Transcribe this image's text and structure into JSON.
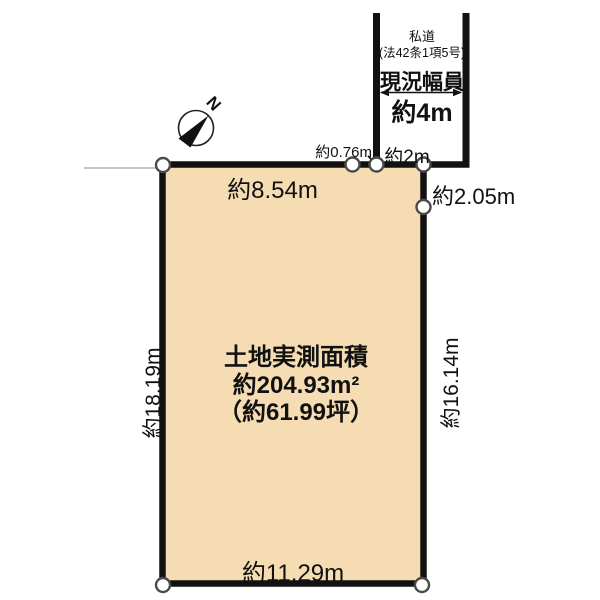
{
  "colors": {
    "background": "#ffffff",
    "parcel_fill": "#f6dcb3",
    "boundary_line": "#111111",
    "marker_stroke": "#4a4a4a",
    "faint_line": "#b3b3b3"
  },
  "compass": {
    "north_label": "N"
  },
  "road": {
    "name": "私道",
    "law_ref": "(法42条1項5号)",
    "width_label": "現況幅員",
    "width_value": "約4m"
  },
  "parcel": {
    "area_title": "土地実測面積",
    "area_sqm": "約204.93m²",
    "area_tsubo": "（約61.99坪）"
  },
  "dimensions": {
    "top_edge": "約8.54m",
    "top_gap": "約0.76m",
    "frontage": "約2m",
    "right_upper": "約2.05m",
    "right_edge": "約16.14m",
    "left_edge": "約18.19m",
    "bottom_edge": "約11.29m"
  }
}
